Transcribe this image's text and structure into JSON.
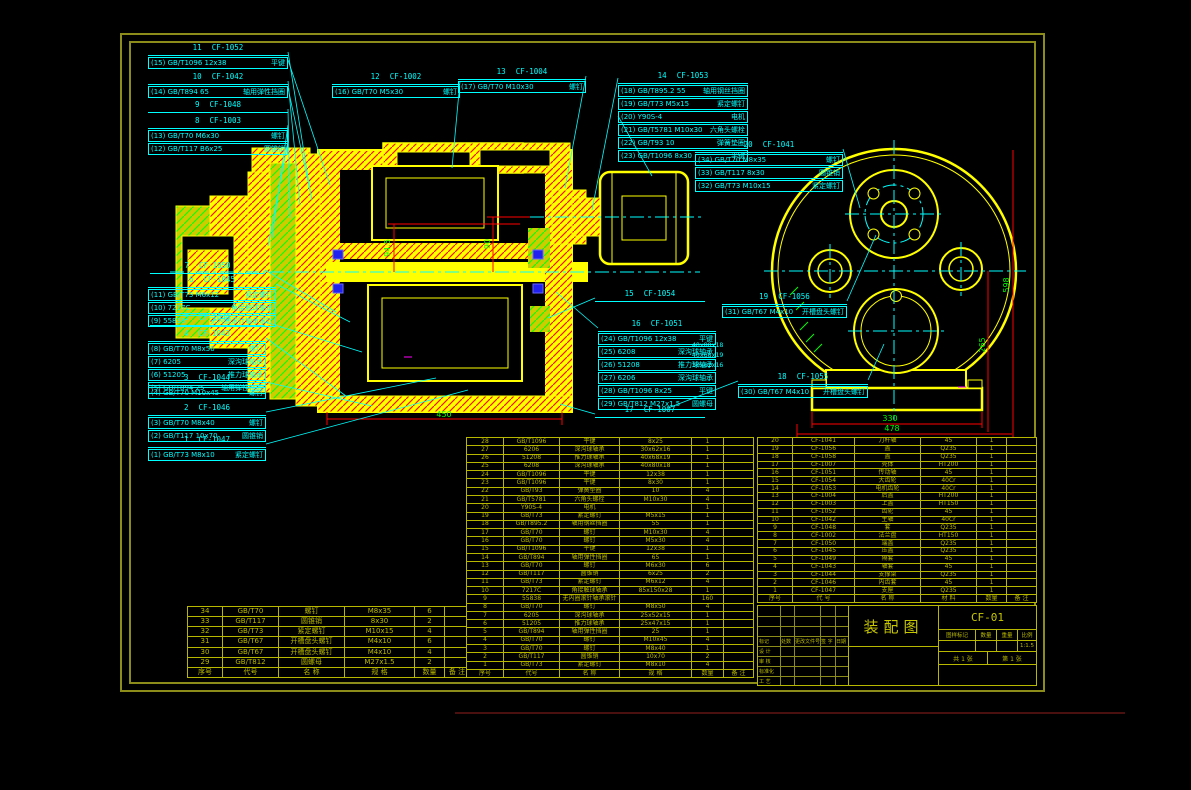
{
  "sheet": {
    "title": "装配图",
    "drawing_no": "CF-01"
  },
  "dims": {
    "v1": "94.5",
    "v2": "90",
    "h1": "450",
    "rv1": "598",
    "rv2": "265",
    "rb1": "330",
    "rb2": "478"
  },
  "side_notes": [
    {
      "text": "40x80x18",
      "x": 692,
      "y": 341
    },
    {
      "text": "40x68x19",
      "x": 692,
      "y": 351
    },
    {
      "text": "30x62x16",
      "x": 692,
      "y": 361
    }
  ],
  "callouts": [
    {
      "num": "11",
      "code": "CF-1052",
      "x": 148,
      "y": 44,
      "w": 140,
      "lx": 310,
      "ly": 190,
      "rows": [
        {
          "ref": "(15)",
          "spec": "GB/T1096 12x38",
          "name": "平键"
        }
      ]
    },
    {
      "num": "10",
      "code": "CF-1042",
      "x": 148,
      "y": 73,
      "w": 140,
      "lx": 300,
      "ly": 205,
      "rows": [
        {
          "ref": "(14)",
          "spec": "GB/T894 65",
          "name": "轴用弹性挡圈"
        }
      ]
    },
    {
      "num": "9",
      "code": "CF-1048",
      "x": 148,
      "y": 101,
      "w": 140,
      "lx": 290,
      "ly": 218,
      "rows": []
    },
    {
      "num": "8",
      "code": "CF-1003",
      "x": 148,
      "y": 117,
      "w": 140,
      "lx": 272,
      "ly": 238,
      "rows": [
        {
          "ref": "(13)",
          "spec": "GB/T70 M6x30",
          "name": "螺钉"
        },
        {
          "ref": "(12)",
          "spec": "GB/T117 B6x25",
          "name": "圆锥销"
        }
      ]
    },
    {
      "num": "12",
      "code": "CF-1002",
      "x": 332,
      "y": 73,
      "w": 128,
      "lx": 452,
      "ly": 168,
      "rows": [
        {
          "ref": "(16)",
          "spec": "GB/T70 M5x30",
          "name": "螺钉"
        }
      ]
    },
    {
      "num": "13",
      "code": "CF-1004",
      "x": 458,
      "y": 68,
      "w": 128,
      "lx": 565,
      "ly": 188,
      "rows": [
        {
          "ref": "(17)",
          "spec": "GB/T70 M10x30",
          "name": "螺钉"
        }
      ]
    },
    {
      "num": "14",
      "code": "CF-1053",
      "x": 618,
      "y": 72,
      "w": 130,
      "sx": 618,
      "sy": 78,
      "lx": 592,
      "ly": 210,
      "rows": [
        {
          "ref": "(18)",
          "spec": "GB/T895.2 55",
          "name": "轴用钢丝挡圈"
        },
        {
          "ref": "(19)",
          "spec": "GB/T73 M5x15",
          "name": "紧定螺钉"
        }
      ]
    },
    {
      "num": "",
      "code": "",
      "x": 618,
      "y": 110,
      "w": 130,
      "sx": 618,
      "sy": 116,
      "lx": 652,
      "ly": 176,
      "rows": [
        {
          "ref": "(20)",
          "spec": "Y90S-4",
          "name": "电机"
        },
        {
          "ref": "(21)",
          "spec": "GB/T5781 M10x30",
          "name": "六角头螺栓"
        },
        {
          "ref": "(22)",
          "spec": "GB/T93 10",
          "name": "弹簧垫圈"
        },
        {
          "ref": "(23)",
          "spec": "GB/T1096 8x30",
          "name": "平键"
        }
      ]
    },
    {
      "num": "20",
      "code": "CF-1041",
      "x": 695,
      "y": 141,
      "w": 148,
      "lx": 860,
      "ly": 208,
      "rows": [
        {
          "ref": "(34)",
          "spec": "GB/T70 M8x35",
          "name": "螺钉"
        },
        {
          "ref": "(33)",
          "spec": "GB/T117 8x30",
          "name": "圆锥销"
        },
        {
          "ref": "(32)",
          "spec": "GB/T73 M10x15",
          "name": "紧定螺钉"
        }
      ]
    },
    {
      "num": "7",
      "code": "CF-1050",
      "x": 150,
      "y": 262,
      "w": 115,
      "lx": 336,
      "ly": 312,
      "rows": []
    },
    {
      "num": "6",
      "code": "CF-1045",
      "x": 148,
      "y": 276,
      "w": 128,
      "lx": 350,
      "ly": 322,
      "rows": [
        {
          "ref": "(11)",
          "spec": "GB/T73 M6x12",
          "name": "紧定螺钉"
        },
        {
          "ref": "(10)",
          "spec": "7217C",
          "name": "角接触球轴承"
        },
        {
          "ref": "(9)",
          "spec": "55838",
          "name": "无内圈滚针轴承滚针"
        }
      ]
    },
    {
      "num": "5",
      "code": "CF-1049",
      "x": 150,
      "y": 314,
      "w": 115,
      "lx": 362,
      "ly": 352,
      "rows": []
    },
    {
      "num": "4",
      "code": "CF-1043",
      "x": 148,
      "y": 330,
      "w": 118,
      "lx": 346,
      "ly": 396,
      "rows": [
        {
          "ref": "(8)",
          "spec": "GB/T70 M8x50",
          "name": "螺钉"
        },
        {
          "ref": "(7)",
          "spec": "6205",
          "name": "深沟球轴承"
        },
        {
          "ref": "(6)",
          "spec": "51205",
          "name": "推力球轴承"
        },
        {
          "ref": "(5)",
          "spec": "GB/T894 25",
          "name": "轴用弹性挡圈"
        }
      ]
    },
    {
      "num": "3",
      "code": "CF-1044",
      "x": 148,
      "y": 374,
      "w": 118,
      "lx": 372,
      "ly": 406,
      "rows": [
        {
          "ref": "(4)",
          "spec": "GB/T70 M10x45",
          "name": "螺钉"
        }
      ]
    },
    {
      "num": "2",
      "code": "CF-1046",
      "x": 148,
      "y": 404,
      "w": 118,
      "lx": 436,
      "ly": 378,
      "rows": [
        {
          "ref": "(3)",
          "spec": "GB/T70 M8x40",
          "name": "螺钉"
        },
        {
          "ref": "(2)",
          "spec": "GB/T117 10x70",
          "name": "圆锥销"
        }
      ]
    },
    {
      "num": "1",
      "code": "CF-1047",
      "x": 148,
      "y": 436,
      "w": 118,
      "lx": 468,
      "ly": 390,
      "rows": [
        {
          "ref": "(1)",
          "spec": "GB/T73 M8x10",
          "name": "紧定螺钉"
        }
      ]
    },
    {
      "num": "15",
      "code": "CF-1054",
      "x": 595,
      "y": 290,
      "w": 110,
      "sx": 595,
      "sy": 298,
      "lx": 548,
      "ly": 318,
      "rows": []
    },
    {
      "num": "19",
      "code": "CF-1056",
      "x": 722,
      "y": 293,
      "w": 125,
      "lx": 876,
      "ly": 235,
      "rows": [
        {
          "ref": "(31)",
          "spec": "GB/T67 M4x10",
          "name": "开槽盘头螺钉"
        }
      ]
    },
    {
      "num": "16",
      "code": "CF-1051",
      "x": 598,
      "y": 320,
      "w": 118,
      "sx": 598,
      "sy": 328,
      "lx": 556,
      "ly": 292,
      "rows": [
        {
          "ref": "(24)",
          "spec": "GB/T1096 12x38",
          "name": "平键"
        },
        {
          "ref": "(25)",
          "spec": "6208",
          "name": "深沟球轴承"
        },
        {
          "ref": "(26)",
          "spec": "51208",
          "name": "推力球轴承"
        },
        {
          "ref": "(27)",
          "spec": "6206",
          "name": "深沟球轴承"
        },
        {
          "ref": "(28)",
          "spec": "GB/T1096 8x25",
          "name": "平键"
        },
        {
          "ref": "(29)",
          "spec": "GB/T812 M27x1.5",
          "name": "圆螺母"
        }
      ]
    },
    {
      "num": "18",
      "code": "CF-1055",
      "x": 738,
      "y": 373,
      "w": 130,
      "sx": 738,
      "sy": 381,
      "lx": 668,
      "ly": 408,
      "rows": [
        {
          "ref": "(30)",
          "spec": "GB/T67 M4x10",
          "name": "开槽盘头螺钉"
        }
      ]
    },
    {
      "num": "17",
      "code": "CF-1007",
      "x": 595,
      "y": 406,
      "w": 110,
      "sx": 595,
      "sy": 414,
      "lx": 560,
      "ly": 404,
      "rows": []
    }
  ],
  "leaders_extra": [
    [
      868,
      380,
      884,
      344
    ],
    [
      288,
      141,
      268,
      246
    ],
    [
      288,
      60,
      330,
      185
    ],
    [
      288,
      88,
      312,
      200
    ]
  ],
  "bom_left": {
    "rows": [
      [
        "34",
        "GB/T70",
        "螺钉",
        "M8x35",
        "6",
        ""
      ],
      [
        "33",
        "GB/T117",
        "圆锥销",
        "8x30",
        "2",
        ""
      ],
      [
        "32",
        "GB/T73",
        "紧定螺钉",
        "M10x15",
        "4",
        ""
      ],
      [
        "31",
        "GB/T67",
        "开槽盘头螺钉",
        "M4x10",
        "6",
        ""
      ],
      [
        "30",
        "GB/T67",
        "开槽盘头螺钉",
        "M4x10",
        "4",
        ""
      ],
      [
        "29",
        "GB/T812",
        "圆螺母",
        "M27x1.5",
        "2",
        ""
      ],
      [
        "序号",
        "代号",
        "名 称",
        "规 格",
        "数量",
        "备 注"
      ]
    ]
  },
  "bom_main": {
    "rows": [
      [
        "28",
        "GB/T1096",
        "平键",
        "8x25",
        "1",
        ""
      ],
      [
        "27",
        "6206",
        "深沟球轴承",
        "30x62x16",
        "1",
        ""
      ],
      [
        "26",
        "51208",
        "推力球轴承",
        "40x68x19",
        "1",
        ""
      ],
      [
        "25",
        "6208",
        "深沟球轴承",
        "40x80x18",
        "1",
        ""
      ],
      [
        "24",
        "GB/T1096",
        "平键",
        "12x38",
        "1",
        ""
      ],
      [
        "23",
        "GB/T1096",
        "平键",
        "8x30",
        "1",
        ""
      ],
      [
        "22",
        "GB/T93",
        "弹簧垫圈",
        "10",
        "4",
        ""
      ],
      [
        "21",
        "GB/T5781",
        "六角头螺栓",
        "M10x30",
        "4",
        ""
      ],
      [
        "20",
        "Y90S-4",
        "电机",
        "",
        "1",
        ""
      ],
      [
        "19",
        "GB/T73",
        "紧定螺钉",
        "M5x15",
        "1",
        ""
      ],
      [
        "18",
        "GB/T895.2",
        "轴用钢丝挡圈",
        "55",
        "1",
        ""
      ],
      [
        "17",
        "GB/T70",
        "螺钉",
        "M10x30",
        "4",
        ""
      ],
      [
        "16",
        "GB/T70",
        "螺钉",
        "M5x30",
        "4",
        ""
      ],
      [
        "15",
        "GB/T1096",
        "平键",
        "12x38",
        "1",
        ""
      ],
      [
        "14",
        "GB/T894",
        "轴用弹性挡圈",
        "65",
        "1",
        ""
      ],
      [
        "13",
        "GB/T70",
        "螺钉",
        "M6x30",
        "6",
        ""
      ],
      [
        "12",
        "GB/T117",
        "圆锥销",
        "6x25",
        "2",
        ""
      ],
      [
        "11",
        "GB/T73",
        "紧定螺钉",
        "M6x12",
        "4",
        ""
      ],
      [
        "10",
        "7217C",
        "角接触球轴承",
        "85x150x28",
        "1",
        ""
      ],
      [
        "9",
        "55838",
        "无内圈滚针轴承滚针",
        "",
        "160",
        ""
      ],
      [
        "8",
        "GB/T70",
        "螺钉",
        "M8x50",
        "4",
        ""
      ],
      [
        "7",
        "6205",
        "深沟球轴承",
        "25x52x15",
        "1",
        ""
      ],
      [
        "6",
        "51205",
        "推力球轴承",
        "25x47x15",
        "1",
        ""
      ],
      [
        "5",
        "GB/T894",
        "轴用弹性挡圈",
        "25",
        "1",
        ""
      ],
      [
        "4",
        "GB/T70",
        "螺钉",
        "M10x45",
        "4",
        ""
      ],
      [
        "3",
        "GB/T70",
        "螺钉",
        "M8x40",
        "1",
        ""
      ],
      [
        "2",
        "GB/T117",
        "圆锥销",
        "10x70",
        "2",
        ""
      ],
      [
        "1",
        "GB/T73",
        "紧定螺钉",
        "M8x10",
        "4",
        ""
      ],
      [
        "序号",
        "代号",
        "名 称",
        "规 格",
        "数量",
        "备 注"
      ]
    ]
  },
  "bom_parts": {
    "rows": [
      [
        "20",
        "CF-1041",
        "刀杆轴",
        "45",
        "1",
        ""
      ],
      [
        "19",
        "CF-1056",
        "盖",
        "Q235",
        "1",
        ""
      ],
      [
        "18",
        "CF-1058",
        "盖",
        "Q235",
        "1",
        ""
      ],
      [
        "17",
        "CF-1007",
        "壳体",
        "HT200",
        "1",
        ""
      ],
      [
        "16",
        "CF-1051",
        "传动轴",
        "45",
        "1",
        ""
      ],
      [
        "15",
        "CF-1054",
        "大齿轮",
        "40Cr",
        "1",
        ""
      ],
      [
        "14",
        "CF-1053",
        "电机齿轮",
        "40Cr",
        "1",
        ""
      ],
      [
        "13",
        "CF-1004",
        "后盖",
        "HT200",
        "1",
        ""
      ],
      [
        "12",
        "CF-1003",
        "上盖",
        "HT150",
        "1",
        ""
      ],
      [
        "11",
        "CF-1052",
        "齿轮",
        "45",
        "1",
        ""
      ],
      [
        "10",
        "CF-1042",
        "主轴",
        "40Cr",
        "1",
        ""
      ],
      [
        "9",
        "CF-1048",
        "套",
        "Q235",
        "1",
        ""
      ],
      [
        "8",
        "CF-1002",
        "法兰盘",
        "HT150",
        "1",
        ""
      ],
      [
        "7",
        "CF-1050",
        "端盖",
        "Q235",
        "1",
        ""
      ],
      [
        "6",
        "CF-1045",
        "压盖",
        "Q235",
        "1",
        ""
      ],
      [
        "5",
        "CF-1049",
        "隔套",
        "45",
        "1",
        ""
      ],
      [
        "4",
        "CF-1043",
        "轴套",
        "45",
        "1",
        ""
      ],
      [
        "3",
        "CF-1044",
        "支撑架",
        "Q235",
        "1",
        ""
      ],
      [
        "2",
        "CF-1046",
        "内齿套",
        "45",
        "1",
        ""
      ],
      [
        "1",
        "CF-1047",
        "支座",
        "Q235",
        "1",
        ""
      ],
      [
        "序号",
        "代 号",
        "名 称",
        "材 料",
        "数量",
        "备 注"
      ]
    ]
  },
  "title_block": {
    "title": "装配图",
    "code": "CF-01",
    "fields": [
      "图样标记",
      "数量",
      "重量",
      "比例"
    ],
    "scale": "1:1.5",
    "sheet_count": "共 1 张",
    "sheet_no": "第 1 张",
    "rev": [
      "标记",
      "处数",
      "更改文件号",
      "签 字",
      "日期"
    ],
    "roles": [
      "设 计",
      "审 核",
      "标准化",
      "工 艺"
    ]
  },
  "colors": {
    "geometry": "#ffff00",
    "hatch": "#ff0000",
    "hatch_alt": "#00ff00",
    "centerline": "#00ffff",
    "callout": "#00ffff",
    "table": "#b8b800",
    "dimension_text": "#00ff00",
    "background": "#000000"
  }
}
